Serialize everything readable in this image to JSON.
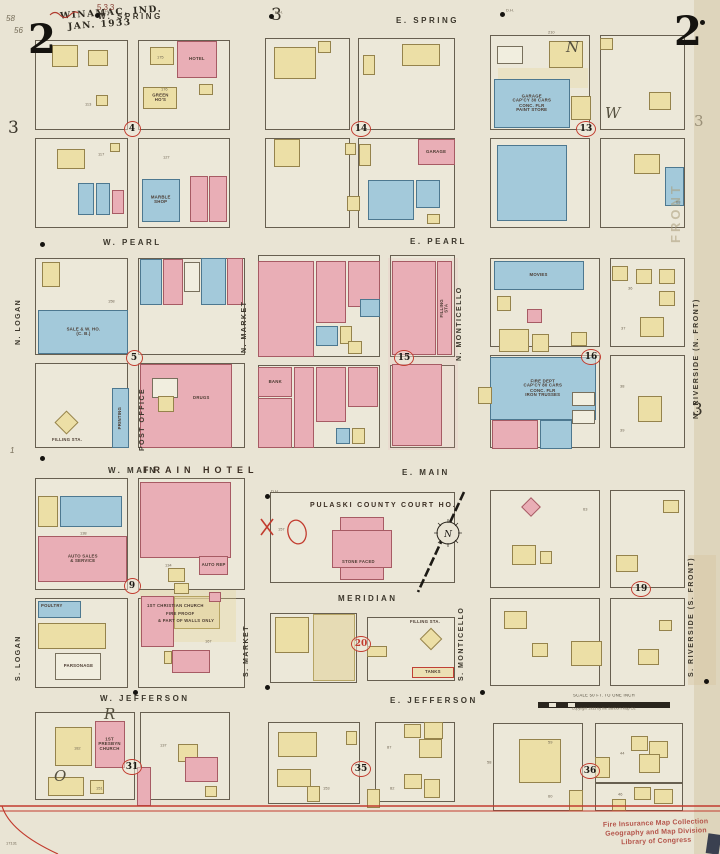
{
  "meta": {
    "map_type": "Sanborn fire insurance map",
    "city_title": "WINAMAC, IND.",
    "date": "JAN. 1933",
    "sheet_number": "2"
  },
  "palette": {
    "paper": "#e9e4d4",
    "frame_yellow": "#ecdfa6",
    "brick_pink": "#e9aeb6",
    "special_blue": "#a3c9da",
    "red": "#c23b2e",
    "ink": "#3c372c"
  },
  "compass": {
    "letter": "N"
  },
  "scale_bar": {
    "label": "SCALE 50 FT. TO ONE INCH",
    "copyright": "Copyright 1933 by the Sanborn Map Co."
  },
  "stamp": {
    "line1": "Fire Insurance Map Collection",
    "line2": "Geography and Map Division",
    "line3": "Library of Congress"
  },
  "blocks": [
    [
      35,
      40,
      93,
      90
    ],
    [
      138,
      40,
      92,
      90
    ],
    [
      35,
      138,
      93,
      90
    ],
    [
      138,
      138,
      92,
      90
    ],
    [
      265,
      38,
      85,
      92
    ],
    [
      358,
      38,
      97,
      92
    ],
    [
      265,
      138,
      85,
      90
    ],
    [
      358,
      138,
      97,
      90
    ],
    [
      490,
      35,
      100,
      95
    ],
    [
      600,
      35,
      85,
      95
    ],
    [
      490,
      138,
      100,
      90
    ],
    [
      600,
      138,
      85,
      90
    ],
    [
      35,
      258,
      93,
      97
    ],
    [
      138,
      258,
      107,
      97
    ],
    [
      35,
      363,
      93,
      85
    ],
    [
      138,
      363,
      107,
      85
    ],
    [
      258,
      255,
      122,
      102
    ],
    [
      258,
      365,
      122,
      83
    ],
    [
      390,
      255,
      65,
      102
    ],
    [
      390,
      365,
      65,
      83
    ],
    [
      490,
      258,
      110,
      89
    ],
    [
      610,
      258,
      75,
      89
    ],
    [
      490,
      355,
      110,
      93
    ],
    [
      610,
      355,
      75,
      93
    ],
    [
      35,
      478,
      93,
      112
    ],
    [
      138,
      478,
      107,
      112
    ],
    [
      270,
      492,
      185,
      91
    ],
    [
      490,
      490,
      110,
      98
    ],
    [
      610,
      490,
      75,
      98
    ],
    [
      35,
      598,
      93,
      90
    ],
    [
      138,
      598,
      107,
      90
    ],
    [
      270,
      613,
      87,
      70
    ],
    [
      367,
      617,
      88,
      64
    ],
    [
      490,
      598,
      110,
      88
    ],
    [
      610,
      598,
      75,
      88
    ],
    [
      35,
      712,
      100,
      88
    ],
    [
      140,
      712,
      90,
      88
    ],
    [
      268,
      722,
      92,
      82
    ],
    [
      375,
      722,
      80,
      80
    ],
    [
      493,
      723,
      90,
      88
    ],
    [
      595,
      723,
      88,
      60
    ],
    [
      595,
      783,
      88,
      28
    ]
  ],
  "buildings": [
    [
      52,
      45,
      26,
      22,
      "y"
    ],
    [
      88,
      50,
      20,
      16,
      "y"
    ],
    [
      150,
      47,
      24,
      18,
      "y"
    ],
    [
      177,
      41,
      40,
      37,
      "p",
      "HOTEL"
    ],
    [
      199,
      84,
      14,
      11,
      "y"
    ],
    [
      143,
      87,
      34,
      22,
      "y",
      "GREEN|HO'S"
    ],
    [
      96,
      95,
      12,
      11,
      "y"
    ],
    [
      57,
      149,
      28,
      20,
      "y"
    ],
    [
      110,
      143,
      10,
      9,
      "y"
    ],
    [
      78,
      183,
      16,
      32,
      "b"
    ],
    [
      96,
      183,
      14,
      32,
      "b"
    ],
    [
      112,
      190,
      12,
      24,
      "p"
    ],
    [
      142,
      179,
      38,
      43,
      "b",
      "MARBLE|SHOP"
    ],
    [
      190,
      176,
      18,
      46,
      "p"
    ],
    [
      209,
      176,
      18,
      46,
      "p"
    ],
    [
      274,
      47,
      42,
      32,
      "y"
    ],
    [
      318,
      41,
      13,
      12,
      "y"
    ],
    [
      363,
      55,
      12,
      20,
      "y"
    ],
    [
      402,
      44,
      38,
      22,
      "y"
    ],
    [
      274,
      139,
      26,
      28,
      "y"
    ],
    [
      345,
      143,
      11,
      12,
      "y"
    ],
    [
      347,
      196,
      13,
      15,
      "y"
    ],
    [
      418,
      139,
      37,
      26,
      "p",
      "GARAGE"
    ],
    [
      359,
      144,
      12,
      22,
      "y"
    ],
    [
      368,
      180,
      46,
      40,
      "b"
    ],
    [
      416,
      180,
      24,
      28,
      "b"
    ],
    [
      427,
      214,
      13,
      10,
      "y"
    ],
    [
      549,
      41,
      34,
      27,
      "y"
    ],
    [
      497,
      46,
      26,
      18,
      "w"
    ],
    [
      494,
      79,
      76,
      49,
      "b",
      "GARAGE|CAP'CY 30 CARS|CONC. FLR|PAINT STORE"
    ],
    [
      571,
      96,
      20,
      24,
      "y"
    ],
    [
      600,
      38,
      13,
      12,
      "y"
    ],
    [
      649,
      92,
      22,
      18,
      "y"
    ],
    [
      497,
      145,
      70,
      76,
      "b"
    ],
    [
      634,
      154,
      26,
      20,
      "y"
    ],
    [
      665,
      167,
      19,
      39,
      "b"
    ],
    [
      42,
      262,
      18,
      25,
      "y"
    ],
    [
      38,
      310,
      90,
      44,
      "b",
      "SALE & W. HO.|(C. B.)"
    ],
    [
      140,
      259,
      22,
      46,
      "b"
    ],
    [
      163,
      259,
      20,
      46,
      "p"
    ],
    [
      184,
      262,
      16,
      30,
      "w"
    ],
    [
      201,
      258,
      25,
      47,
      "b"
    ],
    [
      227,
      258,
      16,
      47,
      "p"
    ],
    [
      58,
      414,
      17,
      17,
      "y",
      null,
      45
    ],
    [
      112,
      388,
      17,
      60,
      "b",
      "PRINTING",
      0,
      "v"
    ],
    [
      140,
      364,
      92,
      84,
      "p"
    ],
    [
      152,
      378,
      26,
      20,
      "w"
    ],
    [
      158,
      396,
      16,
      16,
      "y"
    ],
    [
      258,
      261,
      56,
      96,
      "p"
    ],
    [
      316,
      261,
      30,
      62,
      "p"
    ],
    [
      348,
      261,
      32,
      46,
      "p"
    ],
    [
      360,
      299,
      20,
      18,
      "b"
    ],
    [
      316,
      326,
      22,
      20,
      "b"
    ],
    [
      340,
      326,
      12,
      18,
      "y"
    ],
    [
      348,
      341,
      14,
      13,
      "y"
    ],
    [
      258,
      367,
      34,
      30,
      "p",
      "BANK"
    ],
    [
      258,
      398,
      34,
      50,
      "p"
    ],
    [
      294,
      367,
      20,
      81,
      "p"
    ],
    [
      316,
      367,
      30,
      55,
      "p"
    ],
    [
      348,
      367,
      30,
      40,
      "p"
    ],
    [
      336,
      428,
      14,
      16,
      "b"
    ],
    [
      352,
      428,
      13,
      16,
      "y"
    ],
    [
      392,
      261,
      44,
      94,
      "p"
    ],
    [
      437,
      261,
      15,
      94,
      "p",
      "FILLING|STA",
      0,
      "v"
    ],
    [
      392,
      364,
      50,
      82,
      "p"
    ],
    [
      494,
      261,
      90,
      29,
      "b",
      "MOVIES"
    ],
    [
      497,
      296,
      14,
      15,
      "y"
    ],
    [
      527,
      309,
      15,
      14,
      "p"
    ],
    [
      499,
      329,
      30,
      23,
      "y"
    ],
    [
      532,
      334,
      17,
      18,
      "y"
    ],
    [
      571,
      332,
      16,
      14,
      "y"
    ],
    [
      612,
      266,
      16,
      15,
      "y"
    ],
    [
      636,
      269,
      16,
      15,
      "y"
    ],
    [
      659,
      269,
      16,
      15,
      "y"
    ],
    [
      659,
      291,
      16,
      15,
      "y"
    ],
    [
      640,
      317,
      24,
      20,
      "y"
    ],
    [
      490,
      357,
      106,
      63,
      "b",
      "FIRE DEPT|CAP'CY 80 CARS|CONC. FLR|IRON TRUSSES"
    ],
    [
      478,
      387,
      14,
      17,
      "y"
    ],
    [
      492,
      420,
      46,
      29,
      "p"
    ],
    [
      540,
      420,
      32,
      29,
      "b"
    ],
    [
      572,
      392,
      23,
      14,
      "w"
    ],
    [
      572,
      410,
      23,
      14,
      "w"
    ],
    [
      638,
      396,
      24,
      26,
      "y"
    ],
    [
      38,
      496,
      20,
      31,
      "y"
    ],
    [
      60,
      496,
      62,
      31,
      "b"
    ],
    [
      38,
      536,
      89,
      46,
      "p",
      "AUTO SALES|& SERVICE"
    ],
    [
      140,
      482,
      91,
      76,
      "p"
    ],
    [
      168,
      568,
      17,
      14,
      "y"
    ],
    [
      199,
      556,
      29,
      19,
      "p",
      "AUTO REP"
    ],
    [
      174,
      583,
      15,
      11,
      "y"
    ],
    [
      340,
      517,
      44,
      63,
      "p"
    ],
    [
      332,
      530,
      60,
      38,
      "p"
    ],
    [
      524,
      500,
      14,
      14,
      "p",
      null,
      45
    ],
    [
      512,
      545,
      24,
      20,
      "y"
    ],
    [
      540,
      551,
      12,
      13,
      "y"
    ],
    [
      616,
      555,
      22,
      17,
      "y"
    ],
    [
      663,
      500,
      16,
      13,
      "y"
    ],
    [
      38,
      601,
      43,
      17,
      "b"
    ],
    [
      38,
      623,
      68,
      26,
      "y"
    ],
    [
      55,
      653,
      46,
      27,
      "w",
      "PARSONAGE"
    ],
    [
      141,
      596,
      33,
      51,
      "p"
    ],
    [
      174,
      596,
      46,
      33,
      "t"
    ],
    [
      209,
      592,
      12,
      10,
      "p"
    ],
    [
      164,
      651,
      8,
      13,
      "y"
    ],
    [
      172,
      650,
      38,
      23,
      "p"
    ],
    [
      275,
      617,
      34,
      36,
      "y"
    ],
    [
      313,
      614,
      42,
      67,
      "t"
    ],
    [
      367,
      646,
      20,
      11,
      "y"
    ],
    [
      423,
      631,
      16,
      16,
      "y",
      null,
      45
    ],
    [
      412,
      667,
      42,
      11,
      "tk",
      "TANKS"
    ],
    [
      504,
      611,
      23,
      18,
      "y"
    ],
    [
      532,
      643,
      16,
      14,
      "y"
    ],
    [
      571,
      641,
      31,
      25,
      "y"
    ],
    [
      638,
      649,
      21,
      16,
      "y"
    ],
    [
      659,
      620,
      13,
      11,
      "y"
    ],
    [
      55,
      727,
      37,
      39,
      "y"
    ],
    [
      95,
      721,
      30,
      47,
      "p",
      "1ST|PRESBYN|CHURCH"
    ],
    [
      48,
      777,
      36,
      19,
      "y"
    ],
    [
      90,
      780,
      14,
      14,
      "y"
    ],
    [
      137,
      767,
      14,
      39,
      "p"
    ],
    [
      178,
      744,
      20,
      18,
      "y"
    ],
    [
      185,
      757,
      33,
      25,
      "p"
    ],
    [
      205,
      786,
      12,
      11,
      "y"
    ],
    [
      278,
      732,
      39,
      25,
      "y"
    ],
    [
      346,
      731,
      11,
      14,
      "y"
    ],
    [
      277,
      769,
      34,
      18,
      "y"
    ],
    [
      307,
      786,
      13,
      16,
      "y"
    ],
    [
      404,
      724,
      17,
      14,
      "y"
    ],
    [
      424,
      722,
      19,
      17,
      "y"
    ],
    [
      419,
      739,
      23,
      19,
      "y"
    ],
    [
      404,
      774,
      18,
      15,
      "y"
    ],
    [
      424,
      779,
      16,
      19,
      "y"
    ],
    [
      367,
      789,
      13,
      19,
      "y"
    ],
    [
      519,
      739,
      42,
      44,
      "y"
    ],
    [
      569,
      790,
      14,
      21,
      "y"
    ],
    [
      631,
      736,
      17,
      15,
      "y"
    ],
    [
      649,
      741,
      19,
      17,
      "y"
    ],
    [
      639,
      754,
      21,
      19,
      "y"
    ],
    [
      595,
      757,
      15,
      21,
      "y"
    ],
    [
      634,
      787,
      17,
      13,
      "y"
    ],
    [
      654,
      789,
      19,
      15,
      "y"
    ],
    [
      612,
      799,
      14,
      12,
      "y"
    ]
  ],
  "annotations": [
    [
      "WINAMAC, IND.",
      60,
      8,
      "title-line"
    ],
    [
      "JAN. 1933",
      68,
      20,
      "title-line"
    ],
    [
      "533",
      97,
      3,
      "hand"
    ],
    [
      "58",
      6,
      14,
      "pencil"
    ],
    [
      "56",
      14,
      26,
      "pencil"
    ],
    [
      "2",
      28,
      20,
      "pagenum"
    ],
    [
      "2",
      674,
      12,
      "pagenum"
    ],
    [
      "3",
      271,
      7,
      "num3"
    ],
    [
      "3",
      8,
      120,
      "num3"
    ],
    [
      "3",
      694,
      114,
      "num3-gray"
    ],
    [
      "3",
      692,
      402,
      "num3"
    ],
    [
      "1",
      10,
      446,
      "pencil"
    ],
    [
      "17131",
      6,
      842,
      "num"
    ],
    [
      "W. SPRING",
      98,
      12,
      "street"
    ],
    [
      "E. SPRING",
      396,
      16,
      "street"
    ],
    [
      "W. PEARL",
      103,
      238,
      "street"
    ],
    [
      "E. PEARL",
      410,
      237,
      "street"
    ],
    [
      "W. MAIN",
      108,
      466,
      "street"
    ],
    [
      "E. MAIN",
      402,
      468,
      "street"
    ],
    [
      "MERIDIAN",
      338,
      594,
      "street"
    ],
    [
      "W. JEFFERSON",
      100,
      694,
      "street"
    ],
    [
      "E. JEFFERSON",
      390,
      696,
      "street"
    ],
    [
      "N. LOGAN",
      22,
      338,
      "street-v"
    ],
    [
      "S. LOGAN",
      22,
      674,
      "street-v"
    ],
    [
      "N. MARKET",
      248,
      346,
      "street-v"
    ],
    [
      "S. MARKET",
      250,
      670,
      "street-v"
    ],
    [
      "N. MONTICELLO",
      463,
      354,
      "street-v"
    ],
    [
      "S. MONTICELLO",
      465,
      674,
      "street-v"
    ],
    [
      "N. RIVERSIDE   (N. FRONT)",
      700,
      412,
      "street-v"
    ],
    [
      "S. RIVERSIDE   (S. FRONT)",
      695,
      670,
      "street-v"
    ],
    [
      "FRONT",
      683,
      228,
      "ghost-v"
    ],
    [
      "N",
      566,
      38,
      "pencil-big"
    ],
    [
      "W",
      605,
      104,
      "pencil-big"
    ],
    [
      "R",
      104,
      705,
      "pencil-big"
    ],
    [
      "O",
      54,
      767,
      "pencil-big"
    ],
    [
      "FRAIN  HOTEL",
      143,
      465,
      "frain"
    ],
    [
      "PULASKI  COUNTY  COURT  HO.",
      310,
      502,
      "lm-lg"
    ],
    [
      "STONE FACED",
      342,
      560,
      "lm-xs"
    ],
    [
      "POST OFFICE",
      146,
      444,
      "street-v"
    ],
    [
      "DRUGS",
      193,
      396,
      "lm-xs"
    ],
    [
      "FILLING STA.",
      52,
      438,
      "lm-xs"
    ],
    [
      "FILLING STA.",
      410,
      620,
      "lm-xs"
    ],
    [
      "1ST CHRISTIAN CHURCH",
      147,
      604,
      "lm-xs"
    ],
    [
      "FIRE PROOF",
      166,
      612,
      "lm-xs"
    ],
    [
      "& PART OF WALLS ONLY",
      158,
      619,
      "lm-xs"
    ],
    [
      "POULTRY",
      41,
      604,
      "lm-xs"
    ],
    [
      "D.H.",
      101,
      10,
      "num"
    ],
    [
      "D.H.",
      275,
      11,
      "num"
    ],
    [
      "D.H.",
      506,
      9,
      "num"
    ],
    [
      "D.H.",
      271,
      490,
      "num"
    ],
    [
      "113",
      85,
      103,
      "num"
    ],
    [
      "176",
      161,
      88,
      "num"
    ],
    [
      "175",
      157,
      56,
      "num"
    ],
    [
      "210",
      548,
      31,
      "num"
    ],
    [
      "117",
      98,
      153,
      "num"
    ],
    [
      "127",
      163,
      156,
      "num"
    ],
    [
      "138",
      80,
      532,
      "num"
    ],
    [
      "134",
      165,
      564,
      "num"
    ],
    [
      "153",
      323,
      787,
      "num"
    ],
    [
      "59",
      548,
      741,
      "num"
    ],
    [
      "60",
      548,
      795,
      "num"
    ],
    [
      "44",
      620,
      752,
      "num"
    ],
    [
      "46",
      618,
      793,
      "num"
    ],
    [
      "68",
      676,
      201,
      "num"
    ],
    [
      "37",
      621,
      327,
      "num"
    ],
    [
      "36",
      628,
      287,
      "num"
    ],
    [
      "38",
      620,
      385,
      "num"
    ],
    [
      "39",
      620,
      429,
      "num"
    ],
    [
      "182",
      74,
      747,
      "num"
    ],
    [
      "137",
      160,
      744,
      "num"
    ],
    [
      "151",
      96,
      787,
      "num"
    ],
    [
      "87",
      387,
      746,
      "num"
    ],
    [
      "82",
      390,
      787,
      "num"
    ],
    [
      "58",
      487,
      761,
      "num"
    ],
    [
      "167",
      205,
      640,
      "num"
    ],
    [
      "158",
      108,
      300,
      "num"
    ],
    [
      "157",
      278,
      528,
      "num"
    ],
    [
      "63",
      583,
      508,
      "num"
    ]
  ],
  "block_numbers": [
    [
      "4",
      131,
      128,
      false
    ],
    [
      "14",
      360,
      128,
      false
    ],
    [
      "13",
      585,
      128,
      false
    ],
    [
      "5",
      133,
      357,
      false
    ],
    [
      "15",
      403,
      357,
      false
    ],
    [
      "16",
      590,
      356,
      false
    ],
    [
      "9",
      131,
      585,
      false
    ],
    [
      "19",
      640,
      588,
      false
    ],
    [
      "20",
      360,
      643,
      true
    ],
    [
      "31",
      131,
      766,
      false
    ],
    [
      "35",
      360,
      768,
      false
    ],
    [
      "36",
      589,
      770,
      false
    ]
  ],
  "dots": [
    [
      95,
      13
    ],
    [
      269,
      14
    ],
    [
      500,
      12
    ],
    [
      700,
      20
    ],
    [
      40,
      242
    ],
    [
      40,
      456
    ],
    [
      265,
      494
    ],
    [
      265,
      685
    ],
    [
      480,
      690
    ],
    [
      704,
      679
    ],
    [
      133,
      690
    ]
  ],
  "washes": [
    [
      388,
      258,
      70,
      192,
      "rgba(235,170,175,.14)"
    ],
    [
      140,
      590,
      96,
      52,
      "rgba(230,212,150,.30)"
    ],
    [
      688,
      555,
      28,
      130,
      "rgba(214,198,162,.45)"
    ],
    [
      498,
      68,
      90,
      20,
      "rgba(230,212,150,.30)"
    ]
  ]
}
